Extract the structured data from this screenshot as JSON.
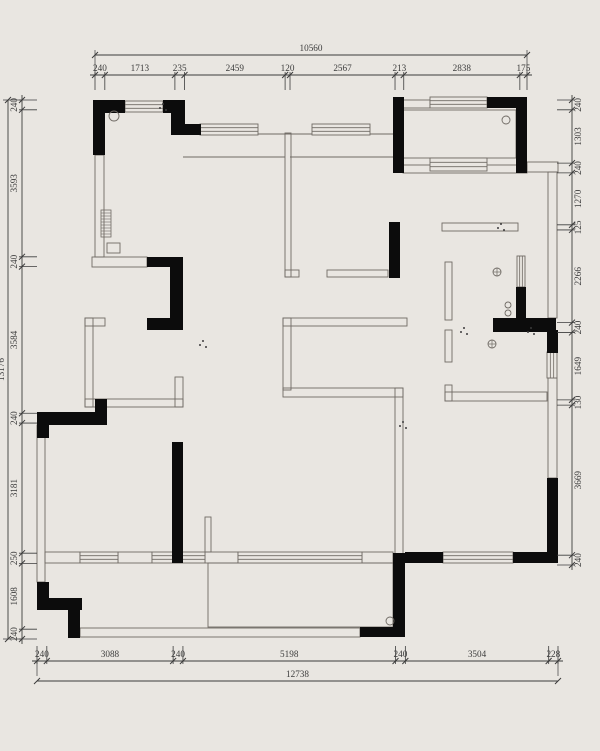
{
  "meta": {
    "width": 600,
    "height": 751,
    "bg_color": "#e9e6e1",
    "wall_color": "#0c0c0c",
    "thin_color": "#6f6a64",
    "dim_color": "#3c3c3c",
    "drawing_type": "floor-plan"
  },
  "dims": {
    "top": {
      "orient": "h",
      "line": 75,
      "total_line": 55,
      "start": 95,
      "end": 527,
      "total": 10560,
      "segments": [
        240,
        1713,
        235,
        2459,
        120,
        2567,
        213,
        2838,
        175
      ],
      "tick": 1,
      "label_side": -1
    },
    "bottom": {
      "orient": "h",
      "line": 661,
      "total_line": 681,
      "start": 37,
      "end": 558,
      "total": 12738,
      "segments": [
        240,
        3088,
        240,
        5198,
        240,
        3504,
        228
      ],
      "tick": -1,
      "label_side": -1
    },
    "left": {
      "orient": "v",
      "line": 22,
      "total_line": 8,
      "start": 100,
      "end": 639,
      "total": 13176,
      "segments": [
        240,
        3593,
        240,
        3584,
        240,
        3181,
        250,
        1608,
        240
      ],
      "tick": 1,
      "label_side": -1
    },
    "right": {
      "orient": "v",
      "line": 572,
      "start": 100,
      "end": 565,
      "segments": [
        240,
        1303,
        240,
        1270,
        125,
        2266,
        240,
        1649,
        130,
        3669,
        240
      ],
      "tick": -1,
      "label_side": 1
    }
  },
  "plan": {
    "black": [
      [
        93,
        100,
        32,
        13
      ],
      [
        93,
        100,
        12,
        55
      ],
      [
        163,
        100,
        22,
        13
      ],
      [
        171,
        113,
        14,
        22
      ],
      [
        171,
        124,
        30,
        11
      ],
      [
        393,
        97,
        11,
        76
      ],
      [
        487,
        97,
        29,
        11
      ],
      [
        516,
        97,
        11,
        76
      ],
      [
        516,
        162,
        11,
        10
      ],
      [
        389,
        222,
        11,
        56
      ],
      [
        147,
        257,
        36,
        10
      ],
      [
        170,
        257,
        13,
        73
      ],
      [
        147,
        318,
        36,
        12
      ],
      [
        95,
        399,
        12,
        26
      ],
      [
        37,
        412,
        12,
        26
      ],
      [
        37,
        412,
        68,
        13
      ],
      [
        172,
        442,
        11,
        121
      ],
      [
        37,
        582,
        12,
        28
      ],
      [
        37,
        598,
        45,
        12
      ],
      [
        68,
        598,
        12,
        40
      ],
      [
        360,
        627,
        45,
        10
      ],
      [
        393,
        553,
        12,
        84
      ],
      [
        405,
        552,
        38,
        11
      ],
      [
        513,
        552,
        45,
        11
      ],
      [
        547,
        478,
        11,
        85
      ],
      [
        547,
        330,
        11,
        23
      ],
      [
        493,
        318,
        63,
        14
      ],
      [
        516,
        287,
        10,
        31
      ]
    ],
    "thin": [
      [
        95,
        155,
        9,
        102
      ],
      [
        92,
        257,
        55,
        10
      ],
      [
        107,
        243,
        13,
        10
      ],
      [
        403,
        100,
        27,
        8
      ],
      [
        403,
        110,
        113,
        48
      ],
      [
        403,
        165,
        124,
        8
      ],
      [
        527,
        162,
        31,
        10
      ],
      [
        548,
        172,
        9,
        146
      ],
      [
        548,
        378,
        9,
        100
      ],
      [
        442,
        223,
        76,
        8
      ],
      [
        445,
        262,
        7,
        58
      ],
      [
        445,
        330,
        7,
        32
      ],
      [
        445,
        385,
        7,
        16
      ],
      [
        445,
        392,
        102,
        9
      ],
      [
        285,
        133,
        6,
        144
      ],
      [
        285,
        270,
        14,
        7
      ],
      [
        327,
        270,
        61,
        7
      ],
      [
        283,
        318,
        124,
        8
      ],
      [
        283,
        318,
        8,
        72
      ],
      [
        283,
        388,
        120,
        9
      ],
      [
        395,
        388,
        8,
        174
      ],
      [
        85,
        318,
        20,
        8
      ],
      [
        85,
        318,
        8,
        89
      ],
      [
        85,
        399,
        98,
        8
      ],
      [
        175,
        377,
        8,
        30
      ],
      [
        37,
        425,
        8,
        157
      ],
      [
        205,
        517,
        6,
        35
      ],
      [
        208,
        563,
        185,
        64
      ],
      [
        80,
        628,
        280,
        9
      ],
      [
        45,
        552,
        35,
        11
      ],
      [
        118,
        552,
        34,
        11
      ],
      [
        205,
        552,
        33,
        11
      ],
      [
        362,
        552,
        31,
        11
      ]
    ],
    "lines": [
      [
        183,
        134,
        393,
        134
      ],
      [
        183,
        157,
        285,
        157
      ],
      [
        290,
        157,
        395,
        157
      ]
    ],
    "windows_h": [
      [
        125,
        101,
        38,
        11
      ],
      [
        200,
        124,
        58,
        11
      ],
      [
        312,
        124,
        58,
        11
      ],
      [
        430,
        97,
        57,
        11
      ],
      [
        430,
        158,
        57,
        13
      ],
      [
        80,
        552,
        38,
        11
      ],
      [
        152,
        552,
        53,
        11
      ],
      [
        238,
        552,
        124,
        11
      ],
      [
        443,
        552,
        70,
        11
      ]
    ],
    "windows_v": [
      [
        517,
        256,
        8,
        31
      ],
      [
        547,
        352,
        10,
        26
      ]
    ],
    "hatch": [
      [
        101,
        210,
        10,
        27
      ]
    ],
    "circles": [
      [
        114,
        116,
        5
      ],
      [
        506,
        120,
        4
      ],
      [
        390,
        621,
        4
      ],
      [
        508,
        305,
        3
      ],
      [
        508,
        313,
        3
      ]
    ],
    "cross_circles": [
      [
        497,
        272
      ],
      [
        492,
        344
      ]
    ],
    "dots": [
      [
        160,
        108
      ],
      [
        498,
        228
      ],
      [
        461,
        332
      ],
      [
        528,
        332
      ],
      [
        200,
        345
      ],
      [
        400,
        426
      ]
    ]
  }
}
